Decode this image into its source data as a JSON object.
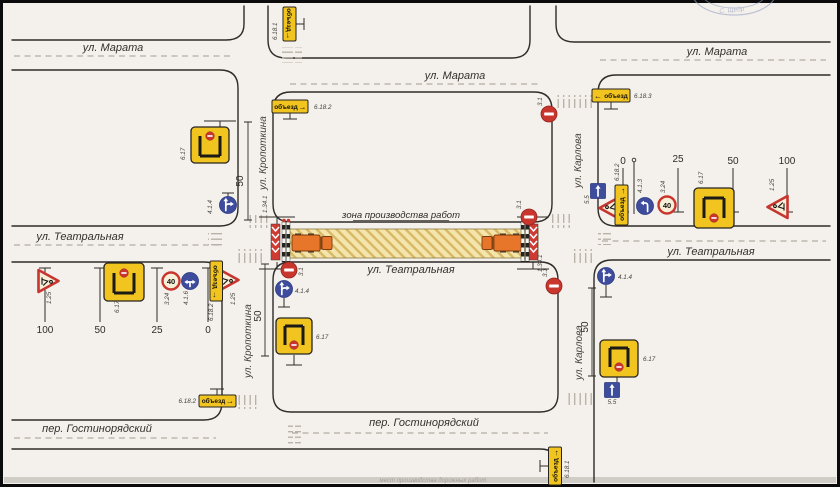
{
  "page": {
    "caption_fragment": "мест производства дорожных работ",
    "stamp_text": "С. Щедр"
  },
  "streets": {
    "marata": "ул. Марата",
    "teatralnaya": "ул. Театральная",
    "gostinoryadsky": "пер. Гостинорядский",
    "kropotkina": "ул. Кропоткина",
    "karlova": "ул. Карлова"
  },
  "work_zone": {
    "label": "зона производства работ"
  },
  "signs": {
    "detour_scheme": "6.17",
    "detour_panel_text": "объезд",
    "detour_straight": "6.18.1",
    "detour_right": "6.18.2",
    "detour_left": "6.18.3",
    "road_works": "1.25",
    "speed_limit_code": "3.24",
    "speed_limit_value": "40",
    "no_entry": "3.1",
    "turn_left": "4.1.3",
    "straight_or_right": "4.1.4",
    "left_or_right": "4.1.6",
    "one_way": "5.5",
    "chevron_board": "1.34.1"
  },
  "icons": {
    "arrow_right": "→",
    "arrow_left": "←"
  },
  "distances": {
    "west": [
      "100",
      "50",
      "25",
      "0"
    ],
    "east": [
      "0",
      "25",
      "50",
      "100"
    ],
    "cross_streets": "50"
  }
}
